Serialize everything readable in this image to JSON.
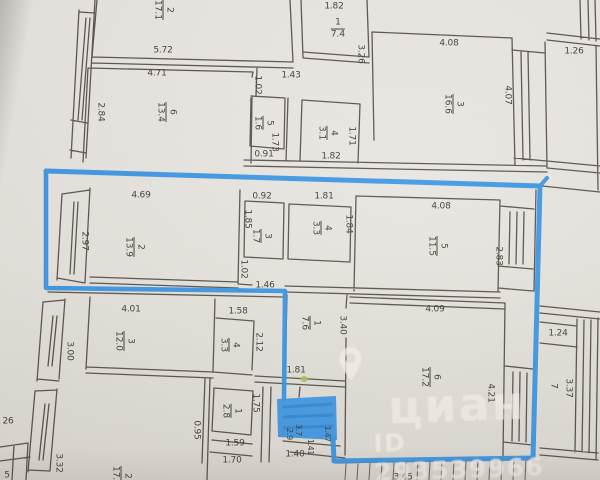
{
  "colors": {
    "paper": "#e7e4de",
    "ink": "#3a362f",
    "marker_blue": "#2f8fe3",
    "marker_blue_deep": "#1b6fc0",
    "watermark": "#f7f1e8",
    "green_mark": "#a9bc5a"
  },
  "watermark": {
    "brand": "циан",
    "id_text": "ID 293539966",
    "pin_icon": "location-pin"
  },
  "plan": {
    "rooms": [
      {
        "n": "2",
        "a": "17.1",
        "x": 163,
        "y": 10,
        "r": 90
      },
      {
        "n": "6",
        "a": "13.4",
        "x": 166,
        "y": 112,
        "r": 90
      },
      {
        "n": "5",
        "a": "1.6",
        "x": 263,
        "y": 123,
        "r": 90
      },
      {
        "n": "4",
        "a": "3.1",
        "x": 327,
        "y": 133,
        "r": 90
      },
      {
        "n": "1",
        "a": "7.4",
        "x": 338,
        "y": 29,
        "r": 0
      },
      {
        "n": "3",
        "a": "16.6",
        "x": 453,
        "y": 104,
        "r": 90
      },
      {
        "n": "2",
        "a": "13.9",
        "x": 134,
        "y": 247,
        "r": 90
      },
      {
        "n": "3",
        "a": "1.7",
        "x": 261,
        "y": 236,
        "r": 90
      },
      {
        "n": "4",
        "a": "3.3",
        "x": 321,
        "y": 228,
        "r": 90
      },
      {
        "n": "5",
        "a": "11.5",
        "x": 437,
        "y": 246,
        "r": 90
      },
      {
        "n": "1",
        "a": "7.6",
        "x": 310,
        "y": 323,
        "r": 90
      },
      {
        "n": "6",
        "a": "17.2",
        "x": 430,
        "y": 377,
        "r": 90
      },
      {
        "n": "3",
        "a": "12.0",
        "x": 124,
        "y": 341,
        "r": 90
      },
      {
        "n": "4",
        "a": "3.3",
        "x": 229,
        "y": 345,
        "r": 90
      },
      {
        "n": "1",
        "a": "2.8",
        "x": 231,
        "y": 411,
        "r": 90
      },
      {
        "n": "2",
        "a": "17.5",
        "x": 121,
        "y": 476,
        "r": 90
      },
      {
        "n": "7",
        "a": "",
        "x": 553,
        "y": 386,
        "r": 90
      }
    ],
    "dims": [
      {
        "t": "5.72",
        "x": 163,
        "y": 51
      },
      {
        "t": "4.71",
        "x": 157,
        "y": 74
      },
      {
        "t": "2.84",
        "x": 100,
        "y": 112,
        "r": 90
      },
      {
        "t": "1.02",
        "x": 257,
        "y": 85,
        "r": 90
      },
      {
        "t": "1.43",
        "x": 291,
        "y": 76
      },
      {
        "t": "1.73",
        "x": 274,
        "y": 142,
        "r": 90
      },
      {
        "t": "0.91",
        "x": 264,
        "y": 155
      },
      {
        "t": "1.82",
        "x": 334,
        "y": 7
      },
      {
        "t": "3.26",
        "x": 360,
        "y": 54,
        "r": 90
      },
      {
        "t": "1.71",
        "x": 351,
        "y": 136,
        "r": 90
      },
      {
        "t": "1.82",
        "x": 331,
        "y": 157
      },
      {
        "t": "4.08",
        "x": 449,
        "y": 44
      },
      {
        "t": "4.07",
        "x": 507,
        "y": 95,
        "r": 90
      },
      {
        "t": "1.26",
        "x": 574,
        "y": 52
      },
      {
        "t": "4.69",
        "x": 141,
        "y": 196
      },
      {
        "t": "2.97",
        "x": 84,
        "y": 241,
        "r": 90
      },
      {
        "t": "0.92",
        "x": 262,
        "y": 197
      },
      {
        "t": "1.85",
        "x": 247,
        "y": 219,
        "r": 90
      },
      {
        "t": "1.81",
        "x": 324,
        "y": 197
      },
      {
        "t": "1.84",
        "x": 348,
        "y": 224,
        "r": 90
      },
      {
        "t": "1.02",
        "x": 243,
        "y": 269,
        "r": 90
      },
      {
        "t": "1.46",
        "x": 265,
        "y": 286
      },
      {
        "t": "4.08",
        "x": 441,
        "y": 207
      },
      {
        "t": "2.83",
        "x": 498,
        "y": 256,
        "r": 90
      },
      {
        "t": "3.40",
        "x": 342,
        "y": 325,
        "r": 90
      },
      {
        "t": "4.09",
        "x": 435,
        "y": 310
      },
      {
        "t": "4.21",
        "x": 490,
        "y": 393,
        "r": 90
      },
      {
        "t": "1.81",
        "x": 296,
        "y": 371
      },
      {
        "t": "2.9",
        "x": 289,
        "y": 434,
        "r": 90,
        "s": 8
      },
      {
        "t": "3.7",
        "x": 298,
        "y": 430,
        "r": 90,
        "s": 8
      },
      {
        "t": "1.47",
        "x": 327,
        "y": 434,
        "r": 90,
        "s": 7.5
      },
      {
        "t": "1.41",
        "x": 310,
        "y": 447,
        "r": 90,
        "s": 7.5
      },
      {
        "t": "1.40",
        "x": 295,
        "y": 455
      },
      {
        "t": "4.01",
        "x": 131,
        "y": 310
      },
      {
        "t": "3.00",
        "x": 69,
        "y": 351,
        "r": 90
      },
      {
        "t": "1.58",
        "x": 238,
        "y": 312
      },
      {
        "t": "2.12",
        "x": 258,
        "y": 342,
        "r": 90
      },
      {
        "t": "1.75",
        "x": 255,
        "y": 403,
        "r": 90
      },
      {
        "t": "0.95",
        "x": 196,
        "y": 430,
        "r": 90
      },
      {
        "t": "1.59",
        "x": 235,
        "y": 444
      },
      {
        "t": "1.70",
        "x": 232,
        "y": 461
      },
      {
        "t": "3.32",
        "x": 58,
        "y": 463,
        "r": 90
      },
      {
        "t": "26",
        "x": 8,
        "y": 422
      },
      {
        "t": "5",
        "x": 7,
        "y": 476
      },
      {
        "t": "1.24",
        "x": 558,
        "y": 334
      },
      {
        "t": "3.37",
        "x": 568,
        "y": 388,
        "r": 90
      },
      {
        "t": "3.45",
        "x": 403,
        "y": 478
      }
    ]
  }
}
